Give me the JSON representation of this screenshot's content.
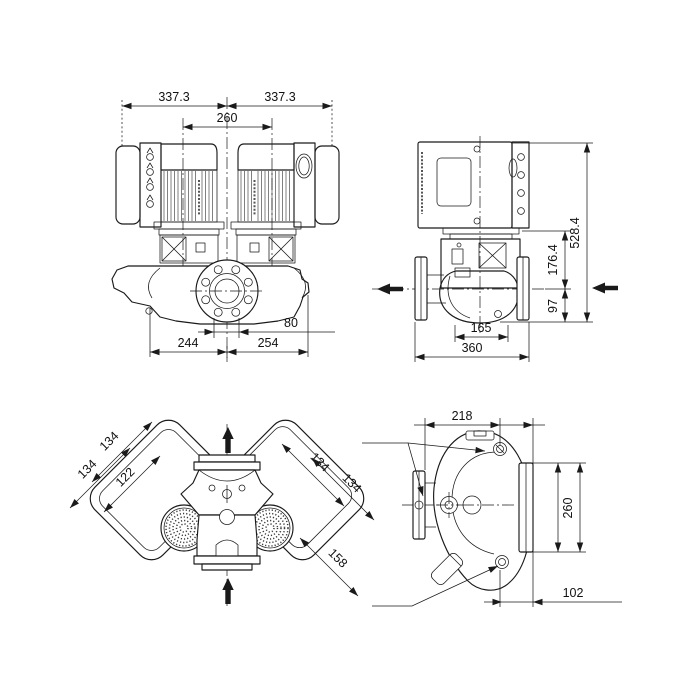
{
  "drawing": {
    "background": "#ffffff",
    "line_color": "#1a1a1a",
    "views": {
      "front": {
        "label": "front view, twin-head in-line pump",
        "dims": {
          "overall_left": "337.3",
          "overall_right": "337.3",
          "head_spacing": "260",
          "bolt_spacing": "80",
          "center_to_left": "244",
          "center_to_right": "254"
        }
      },
      "side": {
        "label": "side view",
        "dims": {
          "total_height": "528.4",
          "motor_to_center": "176.4",
          "center_to_base": "97",
          "head_width": "165",
          "overall_length": "360"
        }
      },
      "top": {
        "label": "top view",
        "dims": {
          "left_outer": "134",
          "left_mid": "134",
          "left_inner": "122",
          "right_outer": "134",
          "right_mid": "134",
          "right_lower": "158"
        }
      },
      "end": {
        "label": "end view",
        "dims": {
          "face_to_axis": "218",
          "port_height": "260",
          "axis_to_back": "102"
        }
      }
    }
  }
}
